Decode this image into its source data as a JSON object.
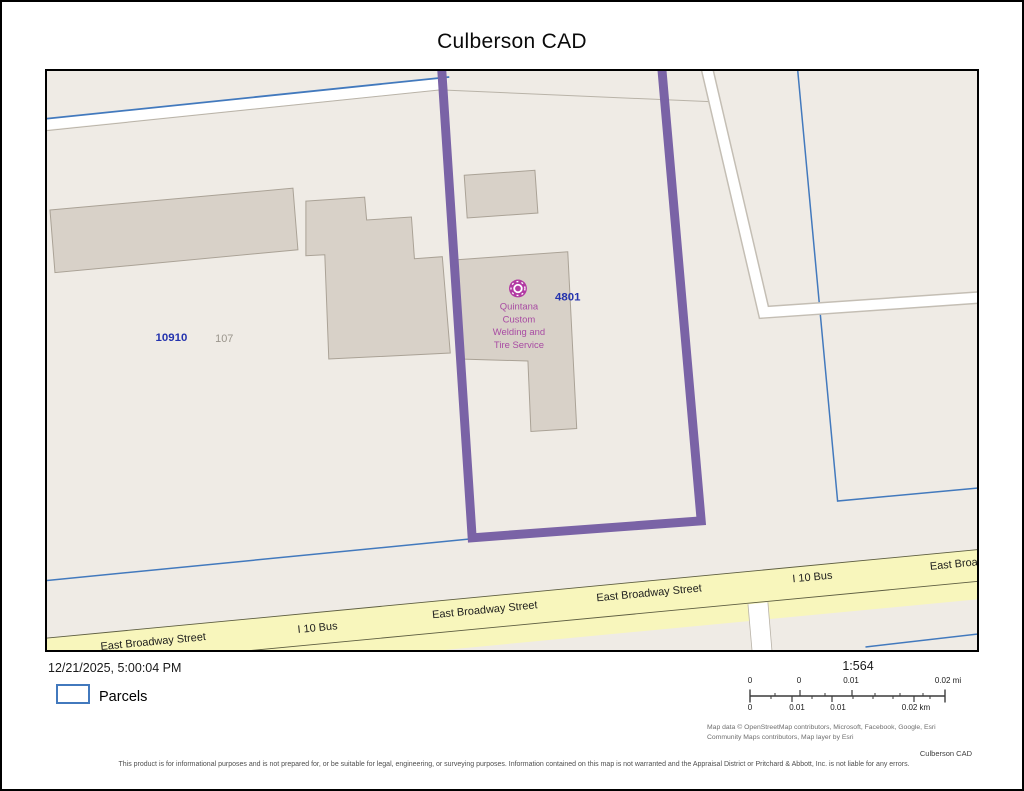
{
  "page": {
    "title": "Culberson CAD"
  },
  "map": {
    "parcel_labels": {
      "left_account": "10910",
      "left_situs": "107",
      "selected_account": "4801"
    },
    "poi": {
      "icon": "tire-shop-marker-icon",
      "name_lines": [
        "Quintana",
        "Custom",
        "Welding and",
        "Tire Service"
      ]
    },
    "street_labels": [
      "East Broadway Street",
      "I 10 Bus",
      "East Broadway Street",
      "East Broadway Street",
      "I 10 Bus",
      "East Broa"
    ],
    "colors": {
      "selected_parcel_outline": "#7a63a6",
      "parcel_boundary": "#4279bd",
      "road_fill": "#f8f6bc",
      "building_fill": "#d8d1c8",
      "map_background": "#efebe5",
      "poi_marker": "#b23aa3",
      "poi_label": "#a84ba3",
      "account_label": "#2433ae"
    }
  },
  "footer": {
    "timestamp": "12/21/2025, 5:00:04 PM",
    "legend": {
      "label": "Parcels"
    },
    "scale": {
      "ratio": "1:564",
      "mi_ticks": [
        "0",
        "0",
        "0.01",
        "0.02 mi"
      ],
      "km_ticks": [
        "0",
        "0.01",
        "0.01",
        "0.02 km"
      ]
    },
    "attribution": {
      "line1": "Map data © OpenStreetMap contributors, Microsoft, Facebook, Google, Esri",
      "line2": "Community Maps contributors, Map layer by Esri"
    },
    "agency": "Culberson CAD",
    "disclaimer": "This product is for informational purposes and is not prepared for, or be suitable for legal, engineering, or surveying purposes. Information contained on this map is not warranted and the Appraisal District or Pritchard & Abbott, Inc. is not liable for any errors."
  }
}
